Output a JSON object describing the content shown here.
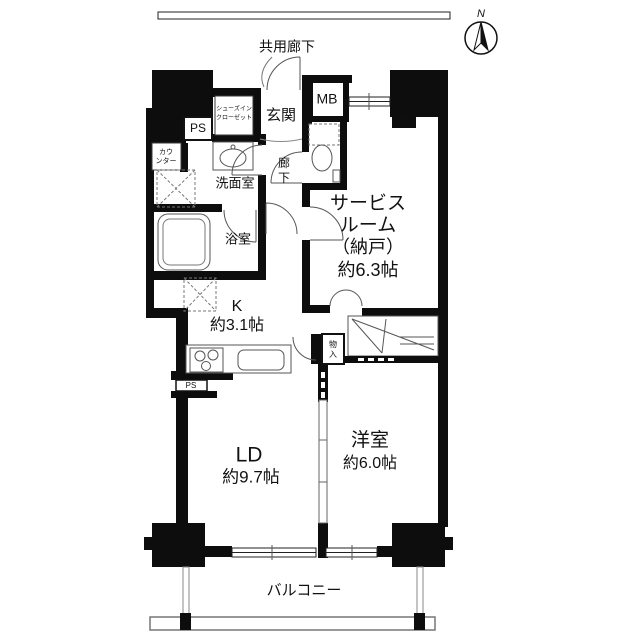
{
  "compass": {
    "north": "N"
  },
  "areas": {
    "common_corridor": "共用廊下",
    "balcony": "バルコニー",
    "entrance": "玄関",
    "hallway": [
      "廊",
      "下"
    ],
    "washroom": "洗面室",
    "bathroom": "浴室",
    "kitchen": {
      "name": "K",
      "size": "約3.1帖"
    },
    "living_dining": {
      "name": "LD",
      "size": "約9.7帖"
    },
    "western_room": {
      "name": "洋室",
      "size": "約6.0帖"
    },
    "service_room": {
      "lines": [
        "サービス",
        "ルーム",
        "（納戸）",
        "約6.3帖"
      ]
    }
  },
  "storage": {
    "shoes_in_closet": [
      "シューズイン",
      "クローゼット"
    ],
    "storage_small": [
      "物",
      "入"
    ],
    "counter": [
      "カウ",
      "ンター"
    ]
  },
  "utility": {
    "meter_box": "MB",
    "pipe_space_entrance": "PS",
    "pipe_space_service": "PS",
    "pipe_space_kitchen": "PS"
  },
  "colors": {
    "wall": "#0d0d0d",
    "line": "#555555",
    "background": "#ffffff"
  }
}
